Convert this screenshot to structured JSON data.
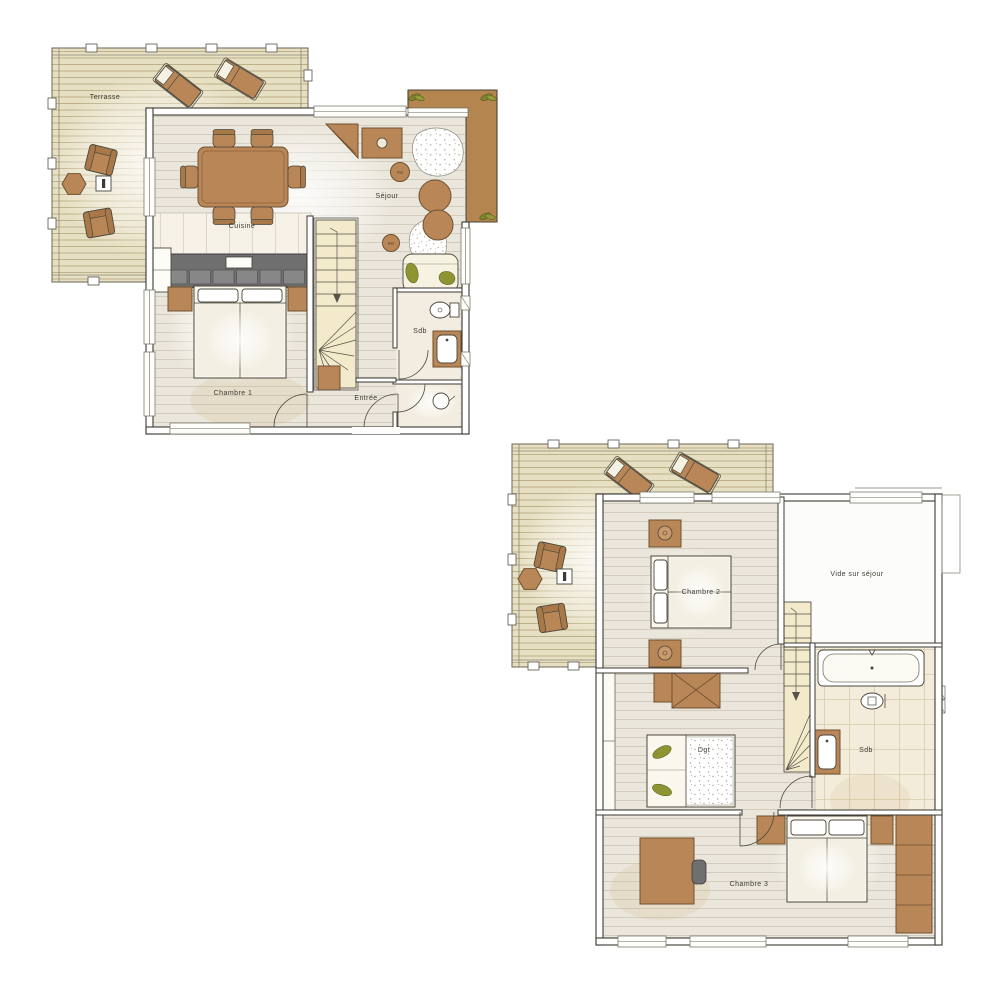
{
  "sheet": {
    "type": "floor-plan",
    "background": "#ffffff"
  },
  "palette": {
    "deck": "#e7dfc2",
    "deck_line": "#b9ac84",
    "wood_floor": "#eae6db",
    "wall_stroke": "#3b3a33",
    "furniture_brown": "#b98757",
    "kitchen_counter": "#6f6f6f",
    "stairs": "#f3e9cb",
    "olive_green": "#8f9433",
    "balcony_brown": "#b5854f",
    "bath_tile": "#f3ecdb",
    "linen": "#faf8ee"
  },
  "floor1": {
    "labels": {
      "terrasse": "Terrasse",
      "sejour": "Séjour",
      "cuisine": "Cuisine",
      "chambre1": "Chambre 1",
      "entree": "Entrée",
      "sdb": "Sdb",
      "rad_top": "Rad",
      "rad_bottom": "Rad"
    }
  },
  "floor2": {
    "labels": {
      "chambre2": "Chambre 2",
      "vide_sur_sejour": "Vide sur séjour",
      "dgt": "Dgt",
      "sdb": "Sdb",
      "chambre3": "Chambre 3"
    }
  }
}
